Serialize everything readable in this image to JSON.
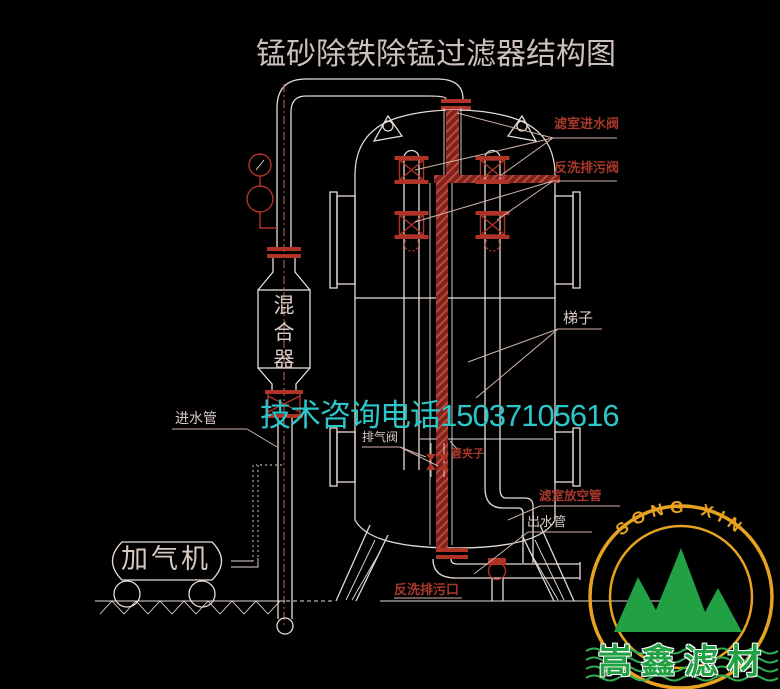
{
  "title": "锰砂除铁除锰过滤器结构图",
  "watermark_phone": "技术咨询电话15037105616",
  "labels": {
    "filter_inlet_valve": "滤室进水阀",
    "backwash_drain_valve": "反洗排污阀",
    "ladder": "梯子",
    "vent_valve": "排气阀",
    "pipe_clamp": "管夹子",
    "chamber_vent_pipe": "滤室放空管",
    "outlet_pipe": "出水管",
    "backwash_drain_outlet": "反洗排污口",
    "inlet_pipe": "进水管",
    "mixer": "混合器",
    "aerator": "加气机"
  },
  "logo": {
    "arc_text": "SONG  XIN",
    "company": "嵩鑫滤材"
  },
  "colors": {
    "bg": "#000000",
    "line": "#e6dcd6",
    "red": "#b03328",
    "label-red": "#a8382c",
    "label-light": "#d8c9c2",
    "title": "#cdc0ba",
    "cyan": "#2cc5c8",
    "leader": "#cfb2a8",
    "centerline": "#c06a5a",
    "logo-yellow": "#e7a21f",
    "logo-green": "#22a044",
    "wave-green": "#2fae52"
  }
}
